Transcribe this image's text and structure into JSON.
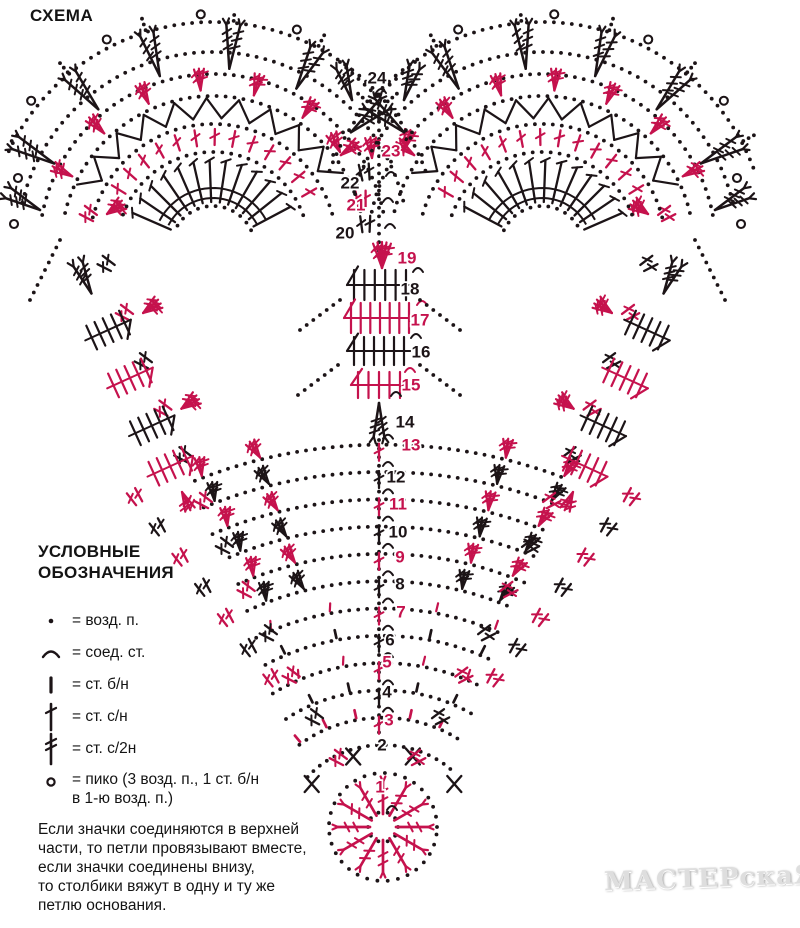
{
  "page": {
    "title": "СХЕМА",
    "watermark": "МАСТЕРскаЯ"
  },
  "colors": {
    "red": "#c5124d",
    "black": "#1c1417"
  },
  "legend": {
    "heading": "УСЛОВНЫЕ\nОБОЗНАЧЕНИЯ",
    "items": [
      {
        "symbol": "chain-dot",
        "label": "= возд. п."
      },
      {
        "symbol": "slip-stitch-arc",
        "label": "= соед. ст."
      },
      {
        "symbol": "single-crochet-bar",
        "label": "= ст. б/н"
      },
      {
        "symbol": "double-crochet-cross",
        "label": "= ст. с/н"
      },
      {
        "symbol": "treble-crochet-cross",
        "label": "= ст. с/2н"
      },
      {
        "symbol": "picot-circle",
        "label": "= пико (3 возд. п., 1 ст. б/н\nв 1-ю возд. п.)"
      }
    ]
  },
  "note": "Если значки соединяются в верхней\nчасти, то петли провязывают вместе,\nесли значки соединены внизу,\nто столбики вяжут в одну и ту же\nпетлю основания.",
  "diagram": {
    "rows": [
      {
        "n": 1,
        "color": "red",
        "x": 380,
        "y": 787
      },
      {
        "n": 2,
        "color": "black",
        "x": 382,
        "y": 745
      },
      {
        "n": 3,
        "color": "red",
        "x": 389,
        "y": 720
      },
      {
        "n": 4,
        "color": "black",
        "x": 387,
        "y": 692
      },
      {
        "n": 5,
        "color": "red",
        "x": 387,
        "y": 662
      },
      {
        "n": 6,
        "color": "black",
        "x": 390,
        "y": 640
      },
      {
        "n": 7,
        "color": "red",
        "x": 401,
        "y": 612
      },
      {
        "n": 8,
        "color": "black",
        "x": 400,
        "y": 584
      },
      {
        "n": 9,
        "color": "red",
        "x": 400,
        "y": 557
      },
      {
        "n": 10,
        "color": "black",
        "x": 398,
        "y": 532
      },
      {
        "n": 11,
        "color": "red",
        "x": 398,
        "y": 504
      },
      {
        "n": 12,
        "color": "black",
        "x": 396,
        "y": 477
      },
      {
        "n": 13,
        "color": "red",
        "x": 411,
        "y": 445
      },
      {
        "n": 14,
        "color": "black",
        "x": 405,
        "y": 422
      },
      {
        "n": 15,
        "color": "red",
        "x": 411,
        "y": 385
      },
      {
        "n": 16,
        "color": "black",
        "x": 421,
        "y": 352
      },
      {
        "n": 17,
        "color": "red",
        "x": 420,
        "y": 320
      },
      {
        "n": 18,
        "color": "black",
        "x": 410,
        "y": 289
      },
      {
        "n": 19,
        "color": "red",
        "x": 407,
        "y": 258
      },
      {
        "n": 20,
        "color": "black",
        "x": 345,
        "y": 233
      },
      {
        "n": 21,
        "color": "red",
        "x": 356,
        "y": 205
      },
      {
        "n": 22,
        "color": "black",
        "x": 350,
        "y": 183
      },
      {
        "n": 23,
        "color": "red",
        "x": 391,
        "y": 151
      },
      {
        "n": 24,
        "color": "black",
        "x": 377,
        "y": 78
      }
    ]
  }
}
